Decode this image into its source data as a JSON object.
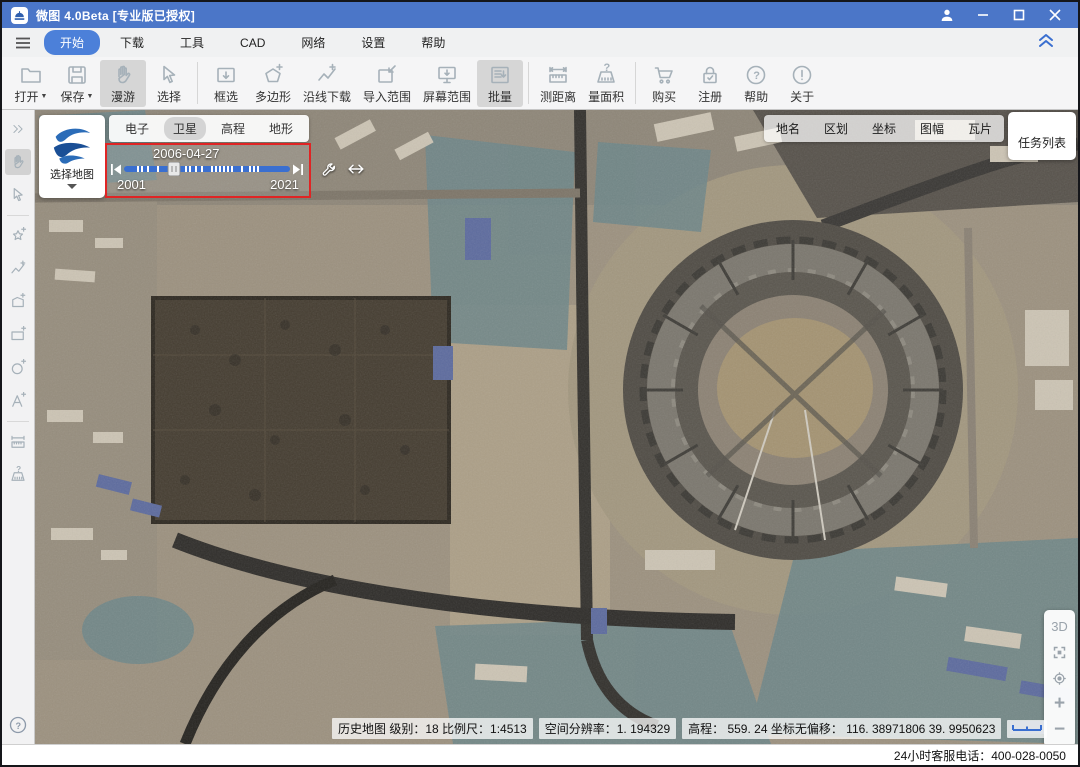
{
  "window": {
    "title": "微图 4.0Beta [专业版已授权]"
  },
  "menu": {
    "items": [
      "开始",
      "下载",
      "工具",
      "CAD",
      "网络",
      "设置",
      "帮助"
    ],
    "active": "开始"
  },
  "toolbar": {
    "buttons": [
      "打开",
      "保存",
      "漫游",
      "选择",
      "框选",
      "多边形",
      "沿线下载",
      "导入范围",
      "屏幕范围",
      "批量",
      "测距离",
      "量面积",
      "购买",
      "注册",
      "帮助",
      "关于"
    ]
  },
  "map": {
    "select_map_label": "选择地图",
    "layer_tabs": [
      "电子",
      "卫星",
      "高程",
      "地形"
    ],
    "active_layer": "卫星",
    "timeline": {
      "date": "2006-04-27",
      "start_year": "2001",
      "end_year": "2021"
    },
    "top_right_buttons": [
      "地名",
      "区划",
      "坐标",
      "图幅",
      "瓦片"
    ],
    "task_list_label": "任务列表",
    "zoom_controls": {
      "mode_3d": "3D",
      "zoom_in": "+",
      "zoom_out": "−"
    },
    "statusbar": {
      "seg1": "历史地图  级别：18  比例尺：1:4513",
      "seg2": "空间分辨率：1. 194329",
      "seg3": "高程：  559. 24  坐标无偏移：  116. 38971806   39. 9950623"
    }
  },
  "footer": {
    "service_phone": "24小时客服电话：400-028-0050"
  },
  "colors": {
    "titlebar_blue": "#4b76c8",
    "accent_blue": "#4c80d9",
    "timeline_border_red": "#e02424",
    "slider_track_blue": "#3a6fd0"
  }
}
